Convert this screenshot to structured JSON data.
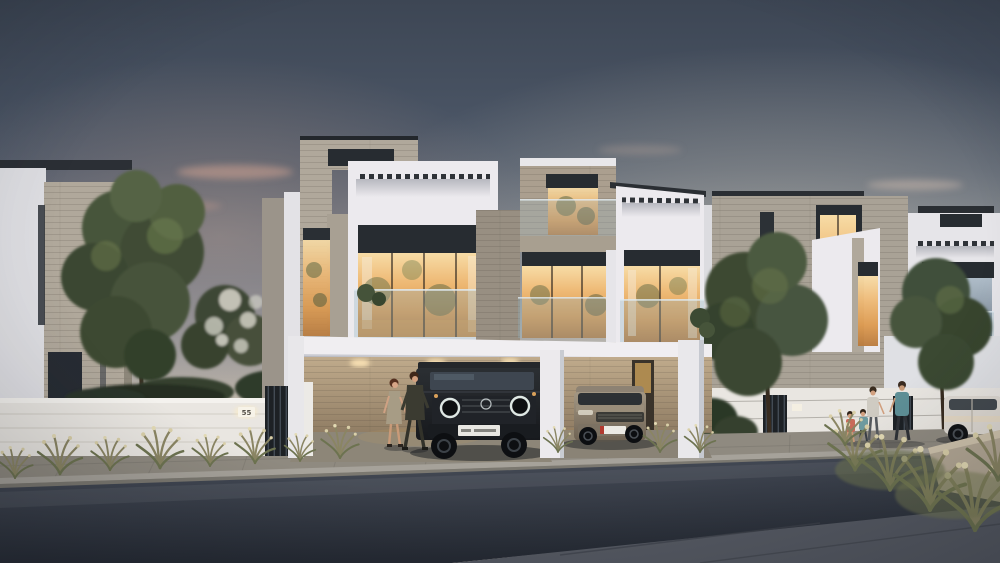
{
  "meta": {
    "image_type": "architectural dusk render",
    "setting": "Modern two-storey townhouse development seen from the street at twilight"
  },
  "palette": {
    "sky_top": "#3d4654",
    "sky_mid": "#707a89",
    "horizon_warm": "#e6d9c2",
    "cloud_pink": "#cfa291",
    "wall_white": "#e9e6e1",
    "volume_white": "#eceaee",
    "stone": "#b0a89b",
    "stone_shaded": "#9b948a",
    "charcoal_band": "#272c31",
    "window_glow": "#eeb975",
    "glass_rail": "#8fb0c0",
    "foliage_dark": "#39462f",
    "foliage_light": "#6f7d4e",
    "grass_dry": "#8a8563",
    "seed_cream": "#d9cfa8",
    "road_light": "#4a505c",
    "road_dark": "#262b34",
    "sidewalk": "#8f8a80",
    "curb": "#a6a29a",
    "near_concrete": "#565a63",
    "suv_dark": "#202328",
    "suv_champagne": "#998d7a",
    "car_white": "#ded9d2"
  },
  "scene": {
    "left_wall": {
      "plaque_number": "55"
    },
    "vehicles": [
      {
        "label": "dark boxy SUV parked in left carport"
      },
      {
        "label": "champagne SUV parked in right carport"
      },
      {
        "label": "white car at far right curb"
      }
    ],
    "people": [
      {
        "label": "couple walking beside dark SUV",
        "count": 2
      },
      {
        "label": "family of four walking on sidewalk",
        "count": 4
      }
    ],
    "landscape": [
      "large tree in front of left house",
      "white flowering tree behind boundary wall",
      "trees in front of right townhouses",
      "ornamental dry grasses along walls and planters"
    ],
    "lighting": [
      "warm interior glow in upper windows",
      "carport ceiling downlights",
      "dusk gradient sky with pink cloud streaks"
    ]
  }
}
